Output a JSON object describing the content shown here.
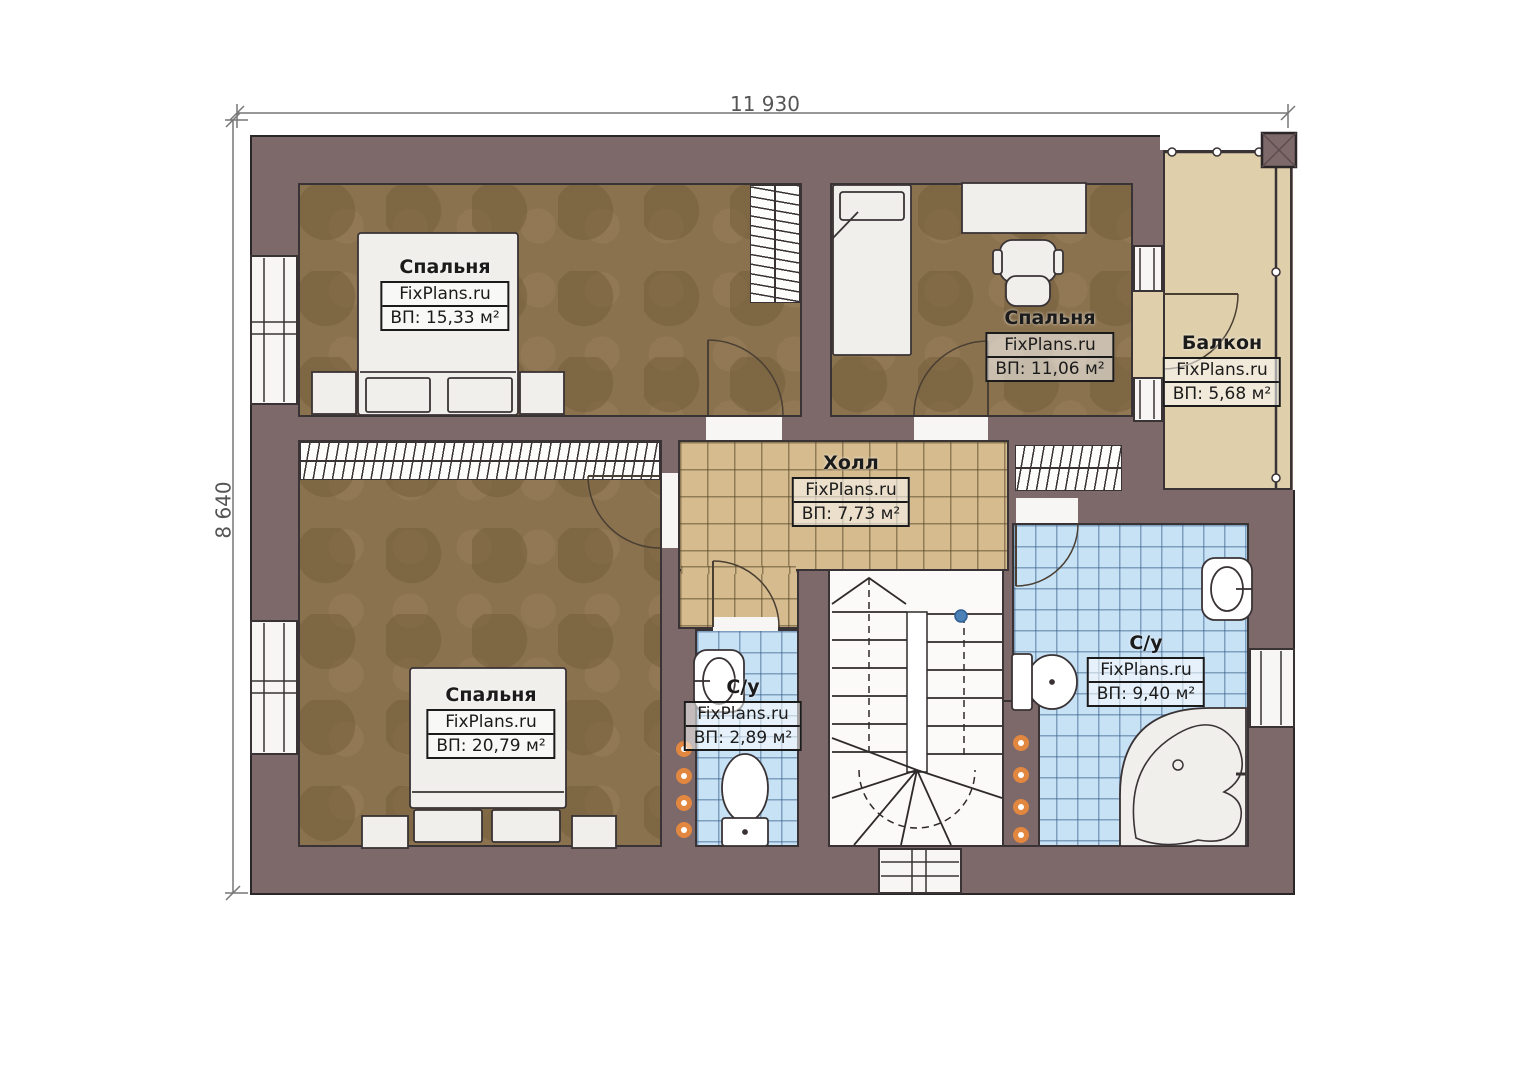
{
  "plan": {
    "watermark": "FixPlans.ru",
    "dimensions": {
      "top": "11 930",
      "left": "8 640"
    },
    "rooms": [
      {
        "id": "bedroom-1",
        "name": "Спальня",
        "area": "ВП: 15,33 м²"
      },
      {
        "id": "bedroom-2",
        "name": "Спальня",
        "area": "ВП: 11,06 м²"
      },
      {
        "id": "balcony",
        "name": "Балкон",
        "area": "ВП: 5,68 м²"
      },
      {
        "id": "hall",
        "name": "Холл",
        "area": "ВП: 7,73 м²"
      },
      {
        "id": "bedroom-3",
        "name": "Спальня",
        "area": "ВП: 20,79 м²"
      },
      {
        "id": "bathroom-small",
        "name": "С/у",
        "area": "ВП: 2,89 м²"
      },
      {
        "id": "bathroom-large",
        "name": "С/у",
        "area": "ВП: 9,40 м²"
      }
    ],
    "colors": {
      "wall": "#7d686a",
      "bedroom_floor": "#8b724f",
      "hall_tile": "#d5bb8e",
      "bath_tile": "#c7e1f5",
      "balcony_floor": "#dfcfab",
      "radiator_dot": "#e2873f",
      "stair_marker": "#4b81b6"
    }
  }
}
